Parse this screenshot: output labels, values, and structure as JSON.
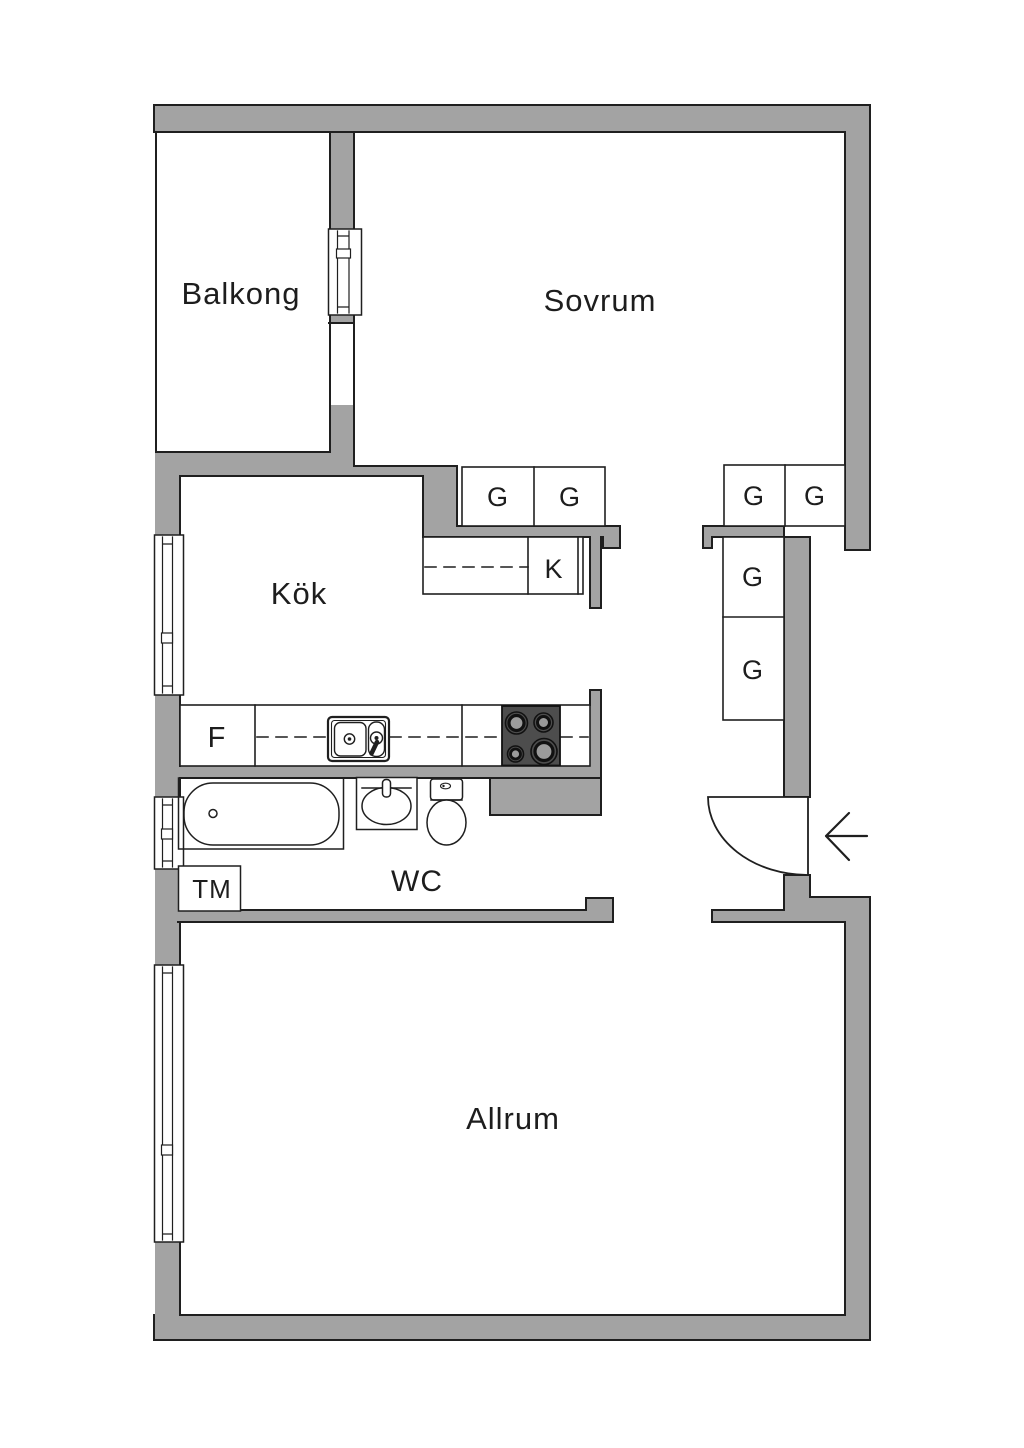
{
  "meta": {
    "type": "apartment-floorplan",
    "language": "sv"
  },
  "colors": {
    "background": "#ffffff",
    "wall": "#a3a3a3",
    "line": "#1f1f1f",
    "text": "#1d1d1d",
    "stove_body": "#4d4d4d",
    "burner_ring": "#111111",
    "burner_center": "#9b9b9b"
  },
  "rooms": {
    "balkong": "Balkong",
    "sovrum": "Sovrum",
    "kok": "Kök",
    "wc": "WC",
    "allrum": "Allrum"
  },
  "fixtures": {
    "wardrobe": "G",
    "kitchen_cabinet": "K",
    "fridge": "F",
    "washing_machine": "TM"
  }
}
